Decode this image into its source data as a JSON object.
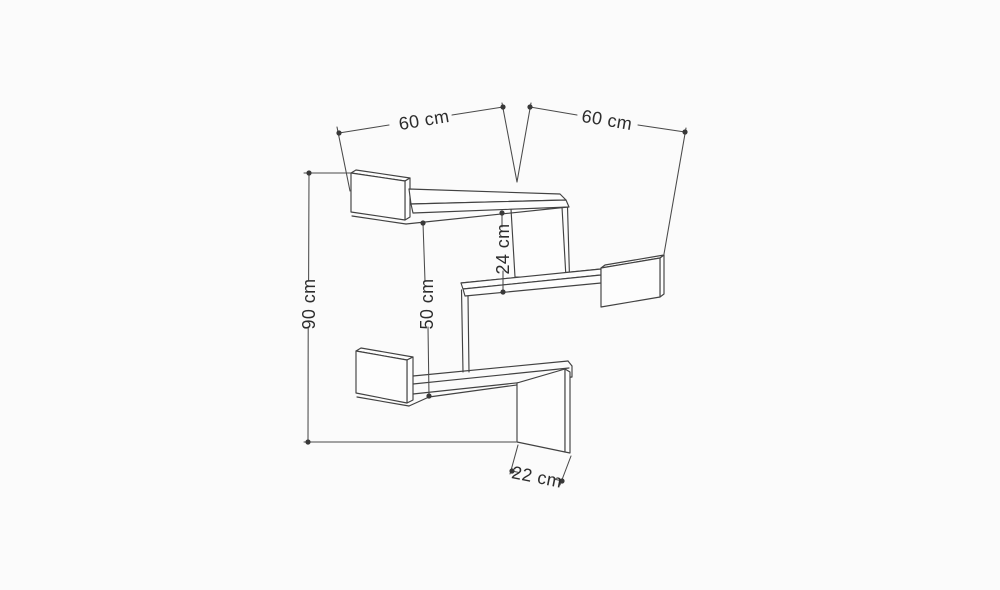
{
  "page": {
    "background_color": "#fbfbfb",
    "line_color": "#424242",
    "text_color": "#2d2d2d"
  },
  "diagram": {
    "type": "technical-drawing",
    "subject": "corner zigzag wall shelf with dimension annotations",
    "unit": "cm",
    "dimensions": [
      {
        "id": "upper-left-shelf-length",
        "label": "60 cm",
        "value": 60,
        "orientation": "diagonal-left"
      },
      {
        "id": "upper-right-shelf-length",
        "label": "60 cm",
        "value": 60,
        "orientation": "diagonal-right"
      },
      {
        "id": "gap-top-to-middle-shelf",
        "label": "24 cm",
        "value": 24,
        "orientation": "vertical"
      },
      {
        "id": "gap-top-to-bottom-shelf",
        "label": "50 cm",
        "value": 50,
        "orientation": "vertical"
      },
      {
        "id": "overall-height",
        "label": "90 cm",
        "value": 90,
        "orientation": "vertical"
      },
      {
        "id": "shelf-depth",
        "label": "22 cm",
        "value": 22,
        "orientation": "diagonal-bottom"
      }
    ]
  }
}
